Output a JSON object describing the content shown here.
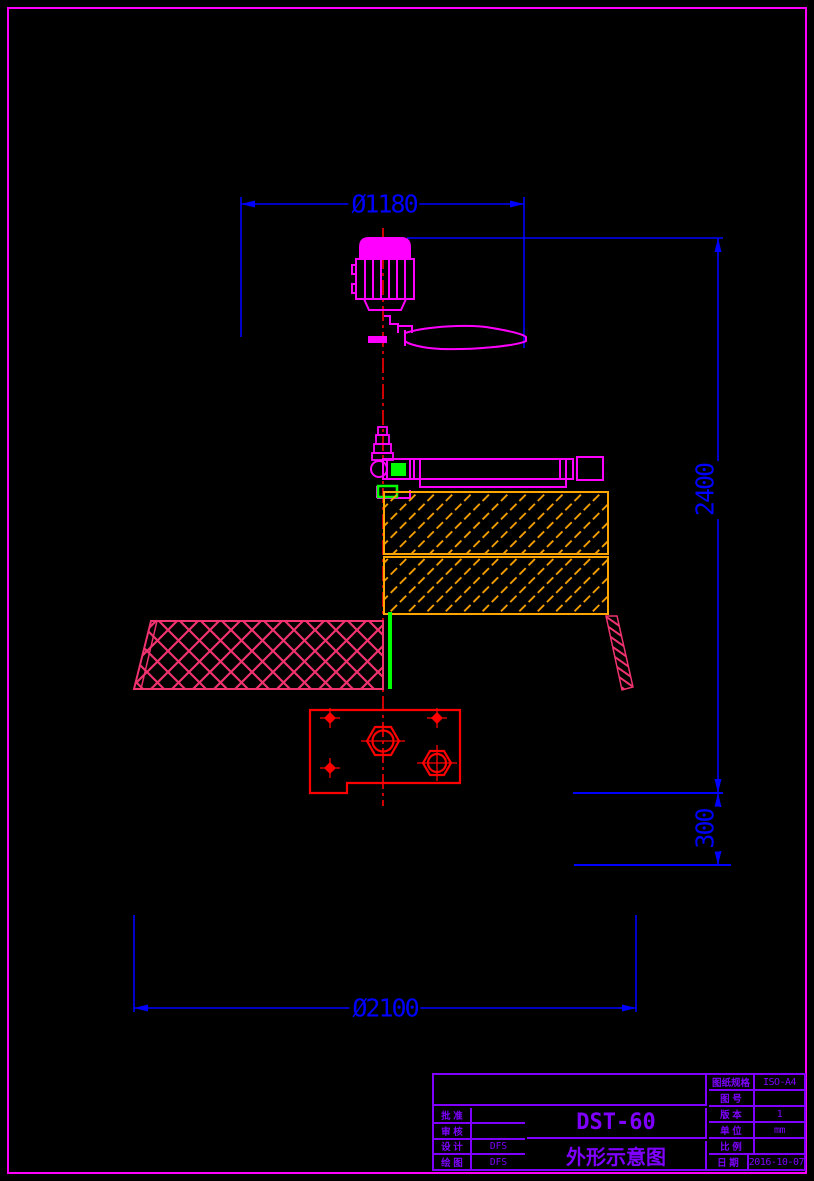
{
  "drawing": {
    "dimensions": {
      "top_diameter": "Ø1180",
      "overall_height": "2400",
      "base_height": "300",
      "base_diameter": "Ø2100"
    },
    "title_block": {
      "model": "DST-60",
      "drawing_title": "外形示意图",
      "rows_left": [
        {
          "label": "批 准",
          "value": ""
        },
        {
          "label": "审 核",
          "value": ""
        },
        {
          "label": "设 计",
          "value": "DFS"
        },
        {
          "label": "绘 图",
          "value": "DFS"
        }
      ],
      "rows_right": [
        {
          "label": "图纸规格",
          "value": "ISO-A4"
        },
        {
          "label": "图 号",
          "value": ""
        },
        {
          "label": "版 本",
          "value": "1"
        },
        {
          "label": "单 位",
          "value": "mm"
        },
        {
          "label": "比 例",
          "value": ""
        },
        {
          "label": "日 期",
          "value": "2016-10-07"
        }
      ]
    },
    "colors": {
      "dimension_blue": "#0000FF",
      "outline_magenta": "#FF00FF",
      "hatch_orange": "#FFA500",
      "mesh_pink": "#F0336E",
      "centerline_red": "#FF0000",
      "accent_green": "#00FF00",
      "title_block_violet": "#7F00FF",
      "background": "#000000"
    }
  }
}
